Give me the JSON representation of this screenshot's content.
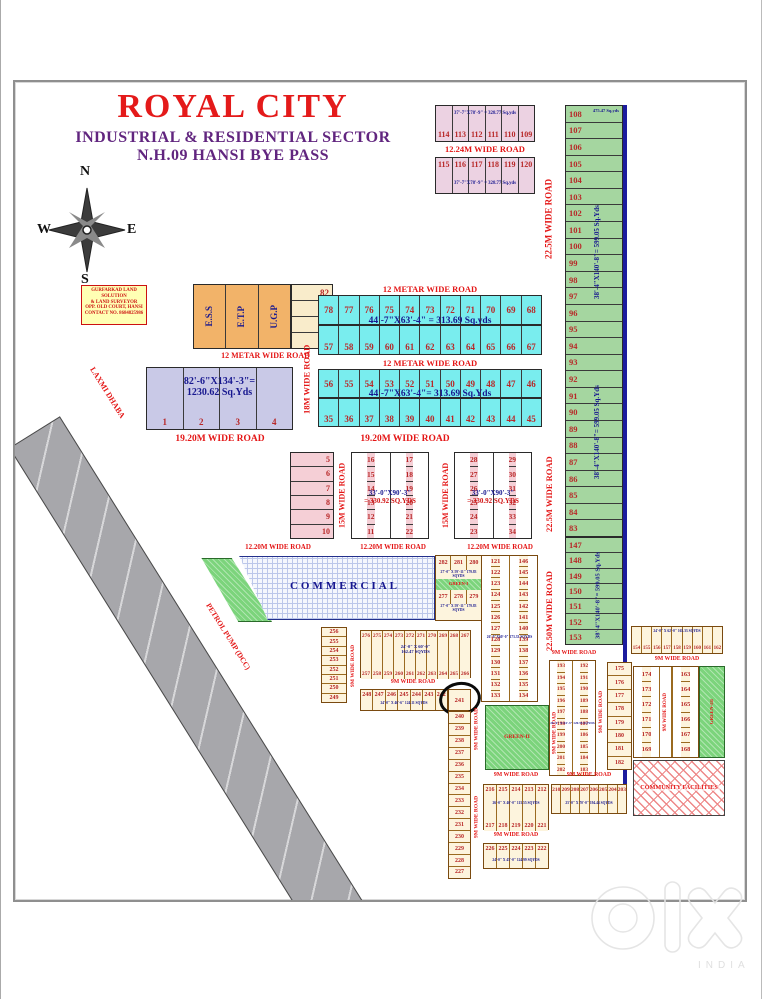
{
  "header": {
    "title": "ROYAL CITY",
    "subtitle1": "INDUSTRIAL & RESIDENTIAL SECTOR",
    "subtitle2": "N.H.09 HANSI BYE PASS"
  },
  "compass": {
    "n": "N",
    "e": "E",
    "s": "S",
    "w": "W"
  },
  "contact_box": {
    "line1": "GURFARKAD LAND SOLUTION",
    "line2": "& LAND SURVEYOR",
    "line3": "OPP. OLD COURT, HANSI",
    "line4": "CONTACT NO. 8684825986"
  },
  "roads": {
    "12m": "12 METAR WIDE ROAD",
    "1224": "12.24M WIDE ROAD",
    "225": "22.5M WIDE ROAD",
    "2250": "22.50M WIDE ROAD",
    "18": "18M WIDE ROAD",
    "1920": "19.20M WIDE ROAD",
    "15": "15M WIDE ROAD",
    "1220": "12.20M WIDE ROAD",
    "9": "9M WIDE ROAD"
  },
  "main_road": {
    "name": "MAIN HANSI BYE PASS ROAD",
    "top": "MAIN HISAR ROAD",
    "bottom": "TO DELHI",
    "dhaba": "LAXMI DHABA",
    "petrol": "PETROL PUMP (DCC)"
  },
  "commercial_label": "COMMERCIAL",
  "community_label": "COMMUNITY FACILITIES",
  "greens": {
    "g1": "GREEN-I",
    "g2": "GREEN-II",
    "g3": "GREEN-III"
  },
  "top_pink": {
    "dim": "37'-7\"X78'-9\" = 328.77 Sq.yds",
    "row1": [
      "114",
      "113",
      "112",
      "111",
      "110",
      "109"
    ],
    "row2": [
      "115",
      "116",
      "117",
      "118",
      "119",
      "120"
    ]
  },
  "green_strip": {
    "dim": "38'-4\"X140'-8\"= 599.05 Sq.Yds",
    "note108": "475.47 Sq.yds",
    "upper": [
      "108",
      "107",
      "106",
      "105",
      "104",
      "103",
      "102",
      "101",
      "100",
      "99",
      "98",
      "97",
      "96",
      "95",
      "94",
      "93",
      "92",
      "91",
      "90",
      "89",
      "88",
      "87",
      "86",
      "85",
      "84",
      "83"
    ],
    "lower": [
      "147",
      "148",
      "149",
      "150",
      "151",
      "152",
      "153"
    ]
  },
  "utilities": {
    "cells": [
      "E.S.S",
      "E.T.P",
      "U.G.P"
    ],
    "plots": [
      "82",
      "81",
      "80",
      "79"
    ]
  },
  "cyan1": {
    "dim": "44'-7\"X63'-4\" = 313.69 Sq.yds",
    "row1": [
      "78",
      "77",
      "76",
      "75",
      "74",
      "73",
      "72",
      "71",
      "70",
      "69",
      "68"
    ],
    "row2": [
      "57",
      "58",
      "59",
      "60",
      "61",
      "62",
      "63",
      "64",
      "65",
      "66",
      "67"
    ]
  },
  "cyan2": {
    "dim": "44'-7\"X63'-4\"= 313.69 Sq.Yds",
    "row1": [
      "56",
      "55",
      "54",
      "53",
      "52",
      "51",
      "50",
      "49",
      "48",
      "47",
      "46"
    ],
    "row2": [
      "35",
      "36",
      "37",
      "38",
      "39",
      "40",
      "41",
      "42",
      "43",
      "44",
      "45"
    ]
  },
  "big4": {
    "nums": [
      "1",
      "2",
      "3",
      "4"
    ],
    "dim1": "82'-6\"X134'-3\"=",
    "dim2": "1230.62 Sq.Yds"
  },
  "col5_10": [
    "5",
    "6",
    "7",
    "8",
    "9",
    "10"
  ],
  "blockA": {
    "col1": [
      "16",
      "15",
      "14",
      "13",
      "12",
      "11"
    ],
    "col2": [
      "17",
      "18",
      "19",
      "20",
      "21",
      "22"
    ]
  },
  "blockB": {
    "col1": [
      "28",
      "27",
      "26",
      "25",
      "24",
      "23"
    ],
    "col2": [
      "29",
      "30",
      "31",
      "32",
      "33",
      "34"
    ]
  },
  "pink_dim1": "33'-0\"X90'-3\"",
  "pink_dim2": "= 330.92 SQ.YDS",
  "block280": {
    "rowA": [
      "282",
      "281",
      "280"
    ],
    "rowB": [
      "277",
      "278",
      "279"
    ],
    "dim": "27'-0\" X 59'-11\" 179.83 SQYDS"
  },
  "strip121": {
    "col1": [
      "121",
      "122",
      "123",
      "124",
      "125",
      "126",
      "127",
      "128",
      "129",
      "130",
      "131",
      "132",
      "133"
    ],
    "col2": [
      "146",
      "145",
      "144",
      "143",
      "142",
      "141",
      "140",
      "139",
      "138",
      "137",
      "136",
      "135",
      "134"
    ],
    "dim": "26'-0\"X60'-0\" 173.33 SQYDS"
  },
  "col256": [
    "256",
    "255",
    "254",
    "253",
    "252",
    "251",
    "250",
    "249"
  ],
  "rows267": {
    "rowA": [
      "276",
      "275",
      "274",
      "273",
      "272",
      "271",
      "270",
      "269",
      "268",
      "267"
    ],
    "rowB": [
      "257",
      "258",
      "259",
      "260",
      "261",
      "262",
      "263",
      "264",
      "265",
      "266"
    ],
    "dim1": "24'-0\" X 60'-0\"",
    "dim2": "162.47 SQYDS"
  },
  "row248": {
    "plots": [
      "248",
      "247",
      "246",
      "245",
      "244",
      "243",
      "242"
    ],
    "circled": "241",
    "dim": "24'-0\" X 46'-6\" 124.11 SQYDS"
  },
  "col227": [
    "240",
    "239",
    "238",
    "237",
    "236",
    "235",
    "234",
    "233",
    "232",
    "231",
    "230",
    "229",
    "228",
    "227"
  ],
  "block193": {
    "col1": [
      "193",
      "194",
      "195",
      "196",
      "197",
      "198",
      "199",
      "200",
      "201",
      "202"
    ],
    "col2": [
      "192",
      "191",
      "190",
      "189",
      "188",
      "187",
      "186",
      "185",
      "184",
      "183"
    ],
    "dim": "20'-0\" X 54'-3\" 120.55 SQYDS"
  },
  "colB": [
    "175",
    "176",
    "177",
    "178",
    "179",
    "180",
    "181",
    "182"
  ],
  "row154": {
    "plots": [
      "154",
      "155",
      "156",
      "157",
      "158",
      "159",
      "160",
      "161",
      "162"
    ],
    "dim": "24'-0\" X 62'-0\" 165.33 SQYDS"
  },
  "block163": {
    "colL": [
      "174",
      "173",
      "172",
      "171",
      "170",
      "169"
    ],
    "colR": [
      "163",
      "164",
      "165",
      "166",
      "167",
      "168"
    ]
  },
  "block212": {
    "rowA": [
      "216",
      "215",
      "214",
      "213",
      "212"
    ],
    "dim": "26'-0\" X 40'-0\" 115.55 SQYDS",
    "rowB": [
      "217",
      "218",
      "219",
      "220",
      "221"
    ]
  },
  "block222": {
    "row": [
      "226",
      "225",
      "224",
      "223",
      "222"
    ],
    "dim": "24'-0\" X 45'-0\" 124.99 SQYDS"
  },
  "block203": {
    "row": [
      "210",
      "209",
      "208",
      "207",
      "206",
      "205",
      "204",
      "203"
    ],
    "dim": "25'-0\" X 70'-0\" 194.44 SQYDS"
  },
  "watermark": {
    "brand_o": "o",
    "brand_l": "l",
    "brand_x": "x",
    "country": "INDIA"
  }
}
